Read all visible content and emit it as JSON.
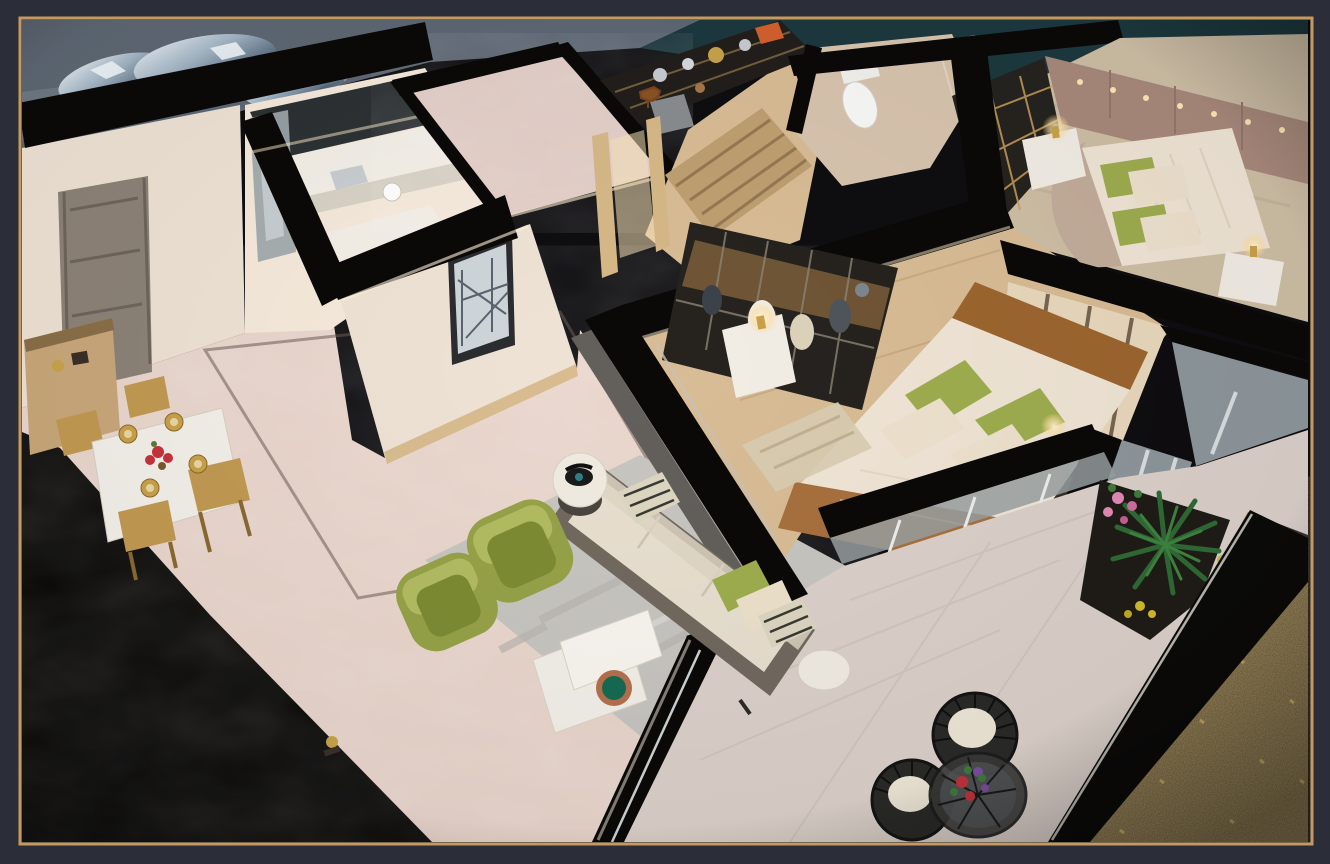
{
  "meta": {
    "type": "photograph",
    "subject": "Miniature apartment scale model (cut-away dollhouse maquette) photographed from above",
    "description": "Warm-lit architectural model of a two-bedroom apartment: entry foyer with grey door and gold dining set, kitchen, display study, bathroom, two bedrooms with cream bedding and green pillows, living room with olive leather armchairs and grey sofa, and an L-shaped balcony terrace with wire chairs and potted plants. The model sits on a dark table with crumpled silver foil and a gold-glitter cloth, inside a thin gold picture frame on a charcoal background."
  },
  "frame": {
    "background": "#2b2e38",
    "border_color": "#c69a5e",
    "border_width": 2,
    "inset_px": 20
  },
  "palette": {
    "photo_bg": "#0e0d10",
    "slate_table": "#5e6874",
    "slate_light": "#7b8692",
    "teal_table": "#1c393f",
    "glitter_gold": "#6b5426",
    "glitter_dot": "#d9b86a",
    "wall_top": "#0a0908",
    "wall_face": "#efe3d5",
    "door_grey": "#8d8378",
    "floor_marble": "#e9d5cb",
    "floor_wood": "#d9bd96",
    "floor_tile": "#ddd2cb",
    "carpet_beige": "#cfbfa6",
    "rug_grey": "#c8c6c1",
    "rug_stripe": "#bfa071",
    "kitchen_bright": "#f6eadb",
    "cabinet_dark": "#2c3134",
    "counter_white": "#f4f0e8",
    "slab_marble": "#e3cdc6",
    "shelf_dark": "#211e1b",
    "wood_furniture": "#c9a87a",
    "wood_frame": "#d7b988",
    "gold_accent": "#c9a44a",
    "gold_chair": "#c29a52",
    "table_marble": "#f4f0ea",
    "sofa_frame": "#72695f",
    "cushion_cream": "#e9e0d0",
    "pillow_cream": "#eee2cc",
    "pillow_green": "#9fae4f",
    "green_chair": "#97a348",
    "green_cushion": "#7d8c33",
    "bed_cream": "#f1e6d6",
    "velvet_brown": "#9d662f",
    "runner_brown": "#a8703e",
    "headboard_taupe": "#a98a7c",
    "headboard_arc": "#c4ad9b",
    "panel_cream": "#ead9bd",
    "wardrobe_dark": "#26231f",
    "glass_grey": "#8e979c",
    "slat_wall": "#63605c",
    "nightstand_white": "#f3eee6",
    "lamp_glow": "#ffdf9e",
    "toilet_white": "#fafaf8",
    "bath_floor": "#d9c5af",
    "plant_green": "#2f6b34",
    "flower_pink": "#e48ab8",
    "flower_red": "#c6333b",
    "flower_purple": "#7a4fa0",
    "flower_yellow": "#d4bc2e",
    "wire_black": "#1c1c1c",
    "seat_cream": "#efe8d8",
    "plate_green": "#176b52",
    "plate_copper": "#b5714f",
    "phone_black": "#1a1a1a",
    "mirror_grey": "#9fa8ad",
    "foil_silver": "#9fb2c2"
  },
  "rooms": [
    {
      "id": "foyer",
      "label": "entry foyer",
      "furniture": [
        "grey entry door",
        "wood shoe cabinet",
        "gold ornament"
      ]
    },
    {
      "id": "dining",
      "label": "dining area",
      "furniture": [
        "white marble table",
        "4 gold chairs",
        "gold place settings",
        "red flower centerpiece"
      ]
    },
    {
      "id": "kitchen",
      "label": "kitchen",
      "furniture": [
        "white counters",
        "dark upper cabinets",
        "sink",
        "mirror panel"
      ]
    },
    {
      "id": "study",
      "label": "display study",
      "furniture": [
        "metal display shelf",
        "silver dishes",
        "orange boxes",
        "horse figurine",
        "grey chair",
        "striped rug"
      ]
    },
    {
      "id": "bathroom",
      "label": "bathroom",
      "furniture": [
        "white toilet",
        "glass shower screen"
      ]
    },
    {
      "id": "bedroom2",
      "label": "second bedroom",
      "furniture": [
        "bed with green and cream pillows",
        "two nightstands",
        "lit gold lamps",
        "glass wardrobe",
        "taupe headboard wall with lights"
      ]
    },
    {
      "id": "master",
      "label": "master bedroom",
      "furniture": [
        "bed with brown velvet headboard",
        "green pillows",
        "brown runner",
        "glass wardrobe with clothes",
        "nightstands with gold lamps",
        "woven headboard panels"
      ]
    },
    {
      "id": "living",
      "label": "living room",
      "furniture": [
        "grey sofa with patterned pillows",
        "two olive leather armchairs",
        "white marble coffee table",
        "green-copper plate",
        "round side table with black rotary phone",
        "grey rug",
        "gold statuette"
      ]
    },
    {
      "id": "terrace",
      "label": "balcony terrace",
      "furniture": [
        "two black wire chairs with cream cushions",
        "round wire table with flowers",
        "planters with palm, pink and yellow flowers",
        "lit railing"
      ]
    }
  ]
}
